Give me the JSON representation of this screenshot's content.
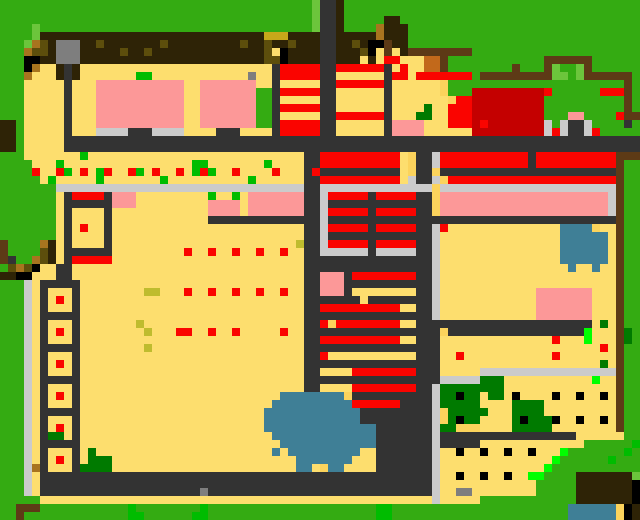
{
  "screen": {
    "width": 640,
    "height": 520,
    "cell_size": 8,
    "grid_cols": 80,
    "grid_rows": 65,
    "description": "pixelated overhead game world map of a shrine town"
  },
  "palette": {
    "G": "#34AB12",
    "g": "#6CC53C",
    "E": "#00BC00",
    "N": "#00FF00",
    "H": "#007A00",
    "Y": "#FDDE6E",
    "y": "#FBD35C",
    "O": "#5D4E0C",
    "o": "#A8741F",
    "M": "#C8A81A",
    "m": "#BFBC2E",
    "D": "#2E2306",
    "S": "#5D3A16",
    "c": "#C2691B",
    "P": "#FC9898",
    "R": "#FA0400",
    "C": "#C40000",
    "W": "#CBCBCB",
    "A": "#7E7E7E",
    "K": "#333333",
    "k": "#000000",
    "B": "#3F7F96"
  },
  "legend": {
    "G": "grass",
    "g": "light-grass",
    "E": "bright-plant",
    "N": "neon-item",
    "H": "dark-hedge",
    "Y": "sand-court",
    "y": "dark-sand",
    "O": "dark-olive-roof",
    "o": "gold-trim",
    "M": "mustard-roof",
    "m": "mustard-dot",
    "D": "dark-brown-roof",
    "S": "wood-wall",
    "c": "chocolate-roof",
    "P": "pink-building",
    "R": "red-marker",
    "C": "dark-red-compound",
    "W": "light-path",
    "A": "stone-gray",
    "K": "road",
    "k": "black-post",
    "B": "water"
  },
  "rows_rle": [
    "39G 1g 2K 1D 37G",
    "39G 1g 2K 1D 37G",
    "39G 1g 2K 1D 5G 2D 30G",
    "4G 1g 34G 1g 2K 1D 4G 1o 3D 29G",
    "4G 1g 28D 3M 4D 2K 5D 1o 3D 29G",
    "3G 1g 1o 1O 1D 3A 2D 1O 7D 1O 9D 1O 2D 1O 2D 1O 3D 2K 2D 1O 1D 2k 1S 2D 29G",
    "3G 1o 2O 1D 3A 5D 1O 2D 1O 14D 1O 1Y 1k 4D 2K 3D 1O 1k 1Y 1S 1Y 1D 8S 21G",
    "3G 2k 2D 3A 23D 2O 1k 4D 2K 3D 1Y 1D 1Y 2R 3Y 2c 1S 12G 6S 6G",
    "3G 1k 1o 2Y 1D 1K 1D 24Y 1K 5R 2K 6R 1K 1Y 1R 2Y 2c 1S 8G 1S 3G 1S 1g 2G 1g 1S 6G",
    "3G 1o 3Y 1D 1K 1D 7Y 2E 12Y 1A 2Y 1K 5R 2K 6Y 1K 2R 1Y 7R 1G 9S 2g 1G 1g 6S 1G",
    "3G 5Y 1K 3Y 11P 2Y 7P 2Y 1K 5Y 2K 6R 1K 6Y 1y 22G 1S 1G",
    "3G 5Y 1K 3Y 11P 2Y 7P 2G 1K 5R 2K 6Y 1K 6Y 1y 3G 9C 1R 6G 3R 1S 1G",
    "3G 5Y 1K 3Y 11P 2Y 7P 2G 1K 5Y 2K 6Y 1K 7Y 1y 2R 9C 10G 1S 1G",
    "3G 5Y 1K 3Y 11P 2Y 7P 2G 1K 5R 2K 6Y 1K 4Y 1H 2Y 3R 9C 10G 1S 1G",
    "3G 5Y 1K 3Y 11P 2Y 7P 2G 1K 5Y 2K 6R 1K 3Y 2H 2Y 3R 9C 3G 2P 4G 1R 2S",
    "2D 1G 5Y 1K 3Y 11P 2Y 7P 2G 1K 5R 2K 6Y 1K 4P 3Y 3R 1C 1R 7C 1W 1G 1W 2K 1W 4G 1K 1G",
    "2D 1G 5Y 1K 3Y 4W 3K 4W 4Y 3K 4Y 1K 5R 2K 6Y 1K 4P 6Y 9C 1W 1R 1W 2K 1W 1R 5G",
    "2D 1G 5Y 72K",
    "2D 1G 5Y 72K",
    "3G 7Y 1E 27Y 2K 10R 1Y 1y 2K 1W 11R 1K 10R 3S",
    "4G 3Y 1E 16Y 2E 7Y 1E 4Y 2K 10R 1Y 1y 2K 1W 11R 1K 10R 1S 2G",
    "4G 1R 2Y 1R 1E 1Y 1R 1Y 1E 1R 2Y 1R 1E 1Y 1R 2Y 1R 1Y 1E 1R 1E 2Y 1R 4Y 1R 3Y 1K 1R 10K 1Y 1y 2K 1y 22K 1S 2G",
    "5G 1Y 1E 5Y 1E 7Y 1E 10Y 1E 6Y 2K 10R 1Y 1W 2K 1W 1y 21R 1S 2G",
    "7G 31W 2K 14W 1y 22W 1S 2G",
    "7G 1Y 1K 4R 1K 3P 9Y 1E 2Y 1E 1Y 7P 2K 1W 5R 1K 5R 2K 1y 21P 1W 1S 2G",
    "7G 1Y 6K 3P 9Y 4P 1Y 7P 2K 1W 13K 1y 21P 1W 1S 2G",
    "7G 1Y 1K 4Y 1K 12Y 4P 1Y 7P 2K 1W 5R 1K 5R 2K 1y 21P 1W 1S 2G",
    "7G 1Y 1K 4Y 1K 12Y 14K 1W 36K 1S 2G",
    "7G 1Y 1K 1Y 1R 2Y 1K 24Y 2K 1W 5R 1K 5R 2K 1W 1R 14Y 4B 1y 2Y 1S 2G",
    "7G 1Y 1K 4Y 1K 24Y 2K 1W 13K 1W 15Y 6B 1Y 1S 2G",
    "1S 4G 1o 1D 1Y 1K 4Y 1K 23Y 1m 2K 1W 5R 1K 5R 2K 1W 15Y 6B 1Y 1S 2G",
    "1S 4G 1O 1D 1Y 6K 9Y 1R 2Y 1R 2Y 1R 2Y 1R 2Y 1R 2Y 2K 6W 1K 5W 2K 1W 15Y 6B 1Y 1S 2G",
    "1S 1K 2G 1o 1O 1D 1Y 1K 5R 24Y 16K 1W 15Y 6B 1Y 1S 2G",
    "1G 1O 1o 1O 1k 2Y 2K 29Y 16K 1W 16Y 1B 2Y 1B 2Y 1S 2G",
    "2D 2k 3Y 2K 29Y 2K 3P 1K 8R 2K 1W 22Y 1S 2G",
    "3G 1W 1Y 5K 28Y 2K 3P 11K 1W 22Y 1S 2G",
    "3G 1W 1Y 1K 3Y 1K 8Y 2m 3Y 1R 2Y 1R 2Y 1R 2Y 1R 2Y 1R 2Y 2K 3P 1K 8Y 2K 1W 12Y 7P 3Y 1S 2G",
    "3G 1W 1Y 1K 1Y 1R 1Y 1K 28Y 7K 1Y 8K 1W 12Y 7P 3Y 1S 2G",
    "3G 1W 1Y 1K 3Y 1K 28Y 2K 10R 2Y 2K 1W 12Y 7P 3Y 1S 2G",
    "3G 1W 1Y 5K 28Y 16K 1W 12Y 7P 3Y 1S 2G",
    "3G 1W 1Y 1K 3Y 1K 7Y 1m 20Y 2K 1R 1y 8R 2Y 22K 1Y 1H 1Y 1S 2G",
    "3G 1W 1Y 1K 1Y 1R 1Y 1K 8Y 1m 3Y 2R 2Y 1R 2Y 1R 5Y 1R 2Y 17K 1y 17K 1N 3Y 1S 1H 1G",
    "3G 1W 1Y 1K 3Y 1K 28Y 2K 10R 2Y 3K 14Y 1R 3Y 1N 3Y 1S 1H 1G",
    "3G 1W 1Y 5K 8Y 1m 19Y 17K 20Y 1R 1Y 1S 2G",
    "3G 1W 1Y 1K 3Y 1K 28Y 2K 1R 11Y 3K 2Y 1R 11Y 1R 7Y 1S 2G",
    "3G 1W 1Y 1K 1Y 1R 1Y 1K 28Y 17K 20Y 1H 1Y 1S 2G",
    "3G 1W 1Y 1K 3Y 1K 28Y 2K 4Y 8R 3K 5Y 17W 1S 2G",
    "3G 1W 1Y 5K 28Y 17K 5W 3H 11Y 1N 2Y 1S 2G",
    "3G 1W 1Y 1K 3Y 1K 28Y 2K 4Y 8R 2K 1W 8H 14Y 1S 2G",
    "3G 1W 1Y 1K 1Y 1R 1Y 1K 25Y 8B 1y 10K 1W 2H 1k 2H 1Y 2H 1Y 1k 4Y 1k 2Y 1k 2Y 1k 1Y 1S 2G",
    "3G 1W 1Y 1K 3Y 1K 24Y 10B 6R 4K 1W 5H 4Y 4H 9Y 1S 2G",
    "3G 1W 1Y 5K 23Y 12B 9K 1W 1y 5H 3Y 4H 9Y 1S 2G",
    "3G 1W 1Y 1K 3Y 1K 23Y 12B 9K 1W 1y 1H 1k 2H 4Y 1H 1k 3H 1k 2Y 1k 2Y 1k 1Y 1S 2G",
    "3G 1W 1Y 1K 1Y 1R 1Y 1K 23Y 14B 7K 1W 2H 3y 4Y 5H 8Y 1S 2G",
    "3G 1W 1Y 1K 2H 1Y 1K 24Y 13B 7K 1W 17K 6Y 2G",
    "3G 1W 1Y 5K 25Y 12B 7K 1W 5K 13Y 6G 1E",
    "3G 1W 1Y 1K 3Y 1K 1Y 1H 22Y 1B 1Y 9B 2Y 7K 1W 2Y 1k 2Y 1k 2Y 1k 2Y 1k 3Y 1N 7G 1E 1G",
    "3G 1W 1Y 1K 1Y 1R 1Y 1K 1Y 3H 23Y 7B 3Y 7K 1W 14Y 1N 6G 1E 3G",
    "3G 1W 1o 1K 3Y 1K 4H 23Y 2B 1Y 1y 2B 4Y 7K 1W 13Y 1N 11G",
    "3G 1W 1Y 49K 1W 2Y 1k 2Y 1k 2Y 1k 2Y 2N 4G 7D 1g",
    "3G 1W 1Y 49K 1W 12Y 5G 7D 1k",
    "3G 1W 1Y 20K 1A 28K 1W 2Y 2A 8Y 5G 7D 1k",
    "5G 49Y 1W 5Y 12G 7D 1k",
    "2G 3S 11G 1E 8G 1E 21G 2E 22G 6B 1y 1k 1D",
    "2G 1S 13G 2E 6G 2E 21G 2E 22G 6B 1y 1k 1D"
  ]
}
